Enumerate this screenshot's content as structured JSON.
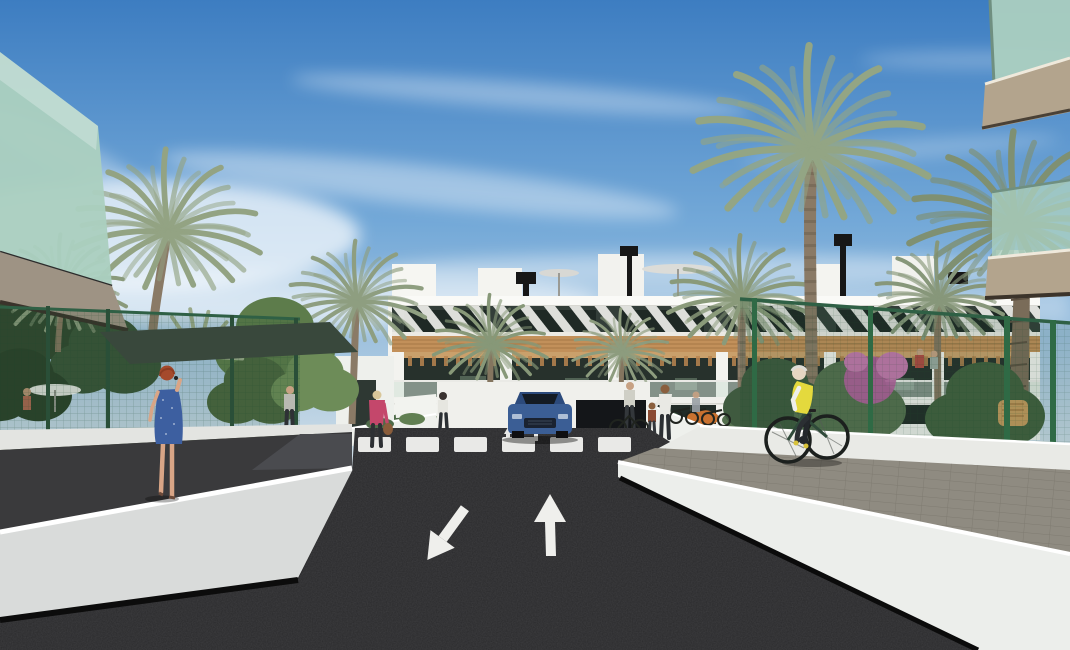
{
  "meta": {
    "alt": "Sunny architectural rendering of a modern white apartment complex with timber accents and glass balconies; palm trees line a dark asphalt access road with two painted lane arrows, a zebra crossing, a blue SUV at the garage entrance, a cyclist in a yellow hi-vis vest on the right sidewalk and a red-haired woman in a blue dress walking on the left walkway."
  },
  "palette": {
    "sky_top": "#3d7dc1",
    "sky_mid": "#74a9d8",
    "sky_low": "#b6cfe2",
    "sky_horizon": "#e2e9ec",
    "building_white": "#f3f3ef",
    "wood_accent": "#c2905a",
    "window_dark": "#333e39",
    "asphalt": "#2a2a2c",
    "wall_white": "#eceeeb",
    "wall_shaded": "#d9dbda",
    "paver_gray": "#8f8b81",
    "fence_green": "#2f6045",
    "palm_green": "#8e9e80",
    "foliage_dark": "#3c5436",
    "glass_green": "#abcfc0",
    "car_blue": "#3b5e95",
    "vest_yellow": "#e4d93d",
    "dress_blue": "#3d5fa0",
    "jacket_pink": "#c4476b",
    "arrow_white": "#efefec"
  },
  "scene": {
    "setting": "street-level view of a new-build residential complex on a clear day",
    "sky": "blue with wispy cirrus cloud streaks, paler toward the horizon",
    "buildings": {
      "main": "long 3-storey white block: rooftop terraces with umbrellas and black vents, top floor with diagonal white brise-soleil louvers over dark glazing, timber cladding band, recessed balconies with pergolas and glass balustrades, dark glazed ground floor behind white planters",
      "foreground_left": "glass balcony corner of near building, top-left",
      "foreground_right": "two stacked glass balconies with timber slabs, right edge"
    },
    "road": {
      "surface": "dark asphalt ramp toward underground garage",
      "lane_arrows": [
        {
          "lane": "left",
          "direction": "toward viewer (down-left)"
        },
        {
          "lane": "right",
          "direction": "away from viewer (up)"
        }
      ],
      "crosswalk": {
        "stripes": 6
      },
      "small_entry_arrows": 2
    },
    "vehicles": [
      {
        "type": "SUV",
        "color": "blue",
        "position": "at garage entrance facing viewer"
      }
    ],
    "people": [
      {
        "id": "woman-blue-dress",
        "description": "red-haired woman in a blue polka-dot dress on the phone, walking away on the left walkway"
      },
      {
        "id": "cyclist",
        "description": "cyclist in yellow hi-vis vest and white sleeves riding along the right sidewalk"
      },
      {
        "id": "woman-pink-jacket",
        "description": "blonde woman in pink jacket carrying a handbag near the entrance path"
      },
      {
        "id": "man-path",
        "description": "man walking on the garden path, background left"
      },
      {
        "id": "woman-crosswalk",
        "description": "woman standing at the left end of the zebra crossing"
      },
      {
        "id": "person-with-bike",
        "description": "person standing with a bicycle near the bike racks"
      },
      {
        "id": "mother-and-child",
        "description": "woman with a child on the right sidewalk"
      },
      {
        "id": "pergola-couple",
        "description": "two residents under the right pergola"
      },
      {
        "id": "pool-person",
        "description": "person by a white umbrella behind the left garden fence"
      }
    ],
    "vegetation": {
      "palms": 10,
      "shade_sail": "dark green sail over the left garden",
      "fences": "green mesh garden fencing on both sides",
      "flowers": "pink bougainvillea on the right, orange shrubs at the planters"
    }
  }
}
